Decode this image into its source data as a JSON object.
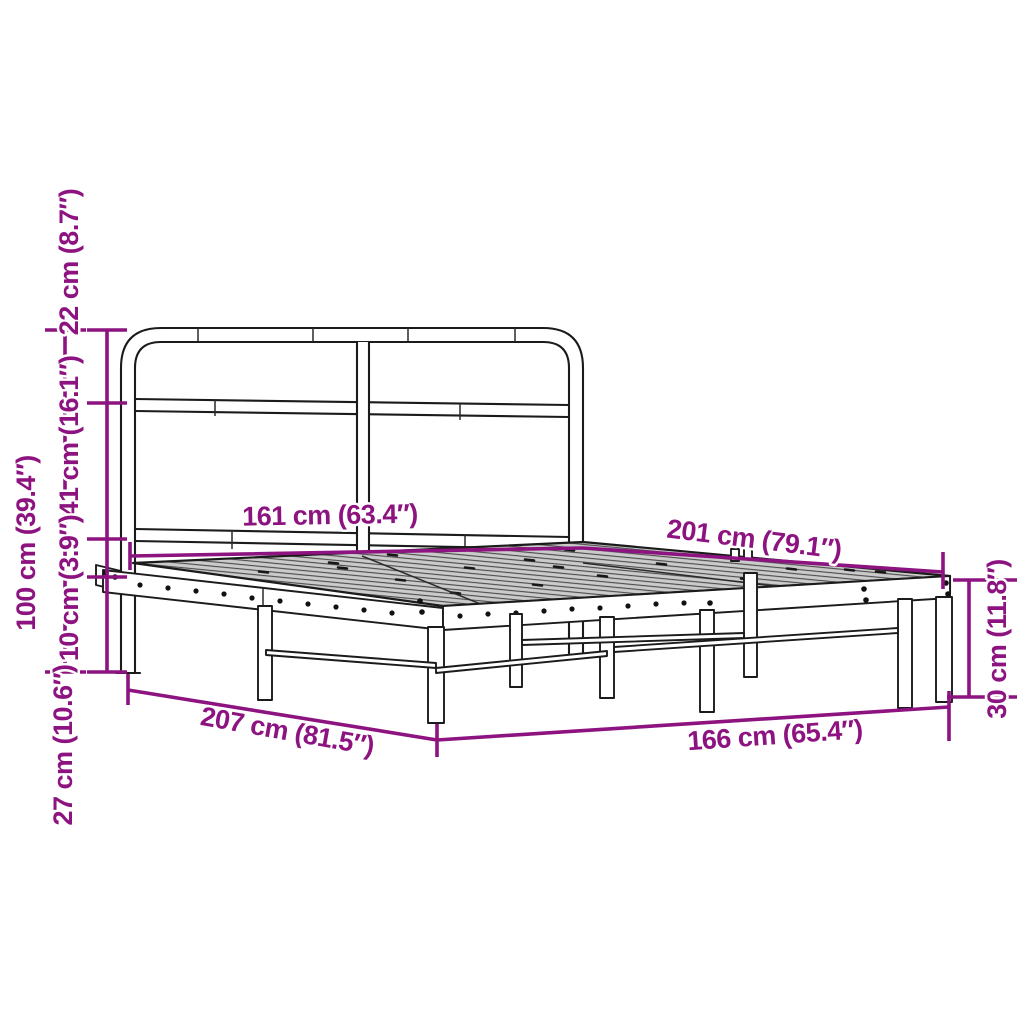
{
  "diagram": {
    "subject": "metal-bed-frame-with-headboard-dimension-diagram",
    "accent_color": "#8D1380",
    "outline_color": "#1b1b1b",
    "mesh_fill_color": "#cbcbcb",
    "background_color": "#ffffff",
    "labels": {
      "total_height": "100 cm (39.4″)",
      "headboard_top": "22 cm (8.7″)",
      "headboard_middle": "41 cm (16.1″)",
      "frame_gap": "10 cm (3.9″)",
      "under_clearance": "27 cm (10.6″)",
      "headboard_width": "161 cm (63.4″)",
      "sleeping_length": "201 cm (79.1″)",
      "total_length": "207 cm (81.5″)",
      "total_width": "166 cm (65.4″)",
      "base_height": "30 cm (11.8″)"
    }
  }
}
